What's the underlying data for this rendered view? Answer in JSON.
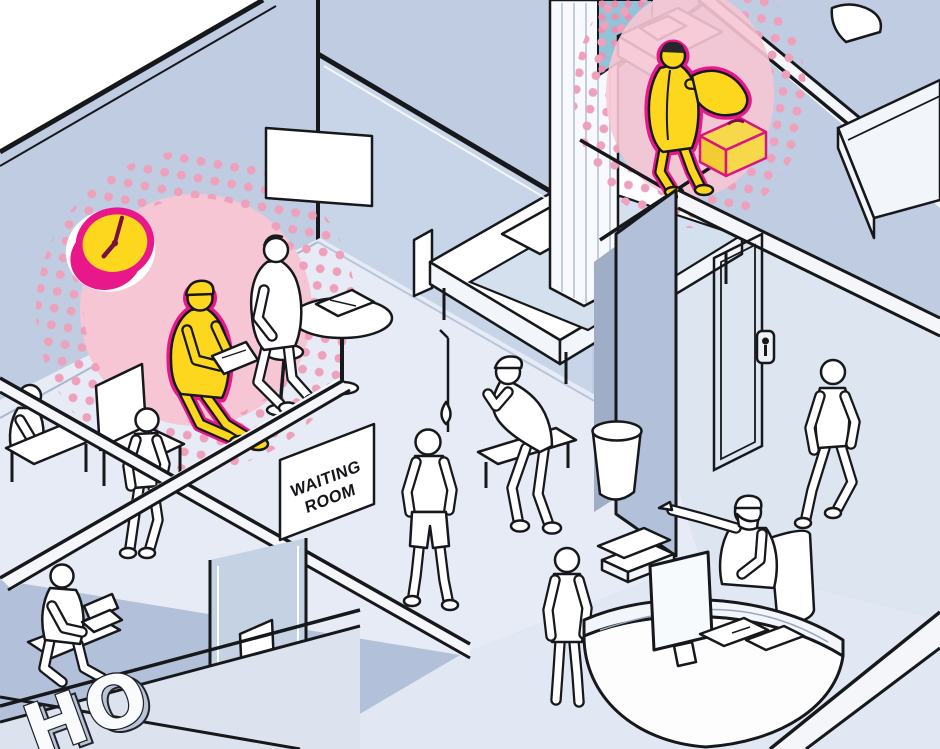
{
  "palette": {
    "wall": "#bfcce2",
    "wall-dark": "#b2c1d9",
    "wall-light": "#cdd8ea",
    "glass": "#c8d5e9",
    "floor": "#e6ebf5",
    "floor-right": "#dde5f1",
    "floor-bottom": "#e2e8f3",
    "band": "#eef1f7",
    "line": "#17181c",
    "white": "#ffffff",
    "hl-yellow": "#fcd71d",
    "hl-magenta": "#e8188b",
    "hl-deep": "#7a1040",
    "glow-pink": "#f7c6d4",
    "dot-pink": "#efa0bb",
    "curtain-teal": "#8fc4d9",
    "suitcase-stroke": "#d81580"
  },
  "signs": {
    "waiting_room_line1": "WAITING",
    "waiting_room_line2": "ROOM",
    "hospital_partial": "HO"
  },
  "clock": {
    "style": "round wall clock, yellow face with magenta rim, highlighted",
    "approx_time": "8:05"
  },
  "highlights": [
    "seated patient in waiting room (yellow with magenta rim, pink halftone glow)",
    "wall clock above waiting patient (yellow/magenta, pink halftone glow)",
    "man putting on jacket beside bed in upper-right room (yellow with magenta rim, pink halftone glow)",
    "suitcase and slippers beside discharged man (yellow/magenta)"
  ],
  "people": [
    {
      "id": "seated-patient-highlighted",
      "pose": "seated in cap, reading document",
      "highlighted": true
    },
    {
      "id": "stool-visitor",
      "pose": "seated on stool beside patient",
      "highlighted": false
    },
    {
      "id": "left-walking-person",
      "pose": "walking near waiting room",
      "highlighted": false
    },
    {
      "id": "desk-seated-person",
      "pose": "seated at small table, lower left",
      "highlighted": false
    },
    {
      "id": "laptop-person",
      "pose": "seated working on laptop, lower left",
      "highlighted": false
    },
    {
      "id": "coughing-person",
      "pose": "hunched on bench coughing into hand",
      "highlighted": false
    },
    {
      "id": "center-walking-person",
      "pose": "walking away in shorts, central corridor",
      "highlighted": false
    },
    {
      "id": "visitor-at-reception",
      "pose": "standing at reception desk",
      "highlighted": false
    },
    {
      "id": "receptionist",
      "pose": "seated behind desk wearing mask, pointing left",
      "highlighted": false
    },
    {
      "id": "right-walking-person",
      "pose": "walking along right corridor",
      "highlighted": false
    },
    {
      "id": "discharged-patient-highlighted",
      "pose": "standing by bed putting on jacket",
      "highlighted": true
    }
  ],
  "objects": [
    "wall-clock",
    "halftone-glow-left",
    "halftone-glow-right",
    "dotted-curtain-panel",
    "waiting-room-sign",
    "picture-frame",
    "round-side-table",
    "magazines",
    "waiting-chair",
    "small-chair",
    "stool",
    "bench",
    "hospital-bed-large",
    "hospital-bed-small",
    "hospital-bed-corner",
    "iv-drip-stand",
    "pillar",
    "trash-can",
    "door-frame",
    "door-lock-plate",
    "suitcase",
    "slippers",
    "reception-desk",
    "computer-monitor",
    "paper-trays",
    "desk-papers",
    "laptop",
    "office-chair",
    "hospital-exterior-letters"
  ]
}
